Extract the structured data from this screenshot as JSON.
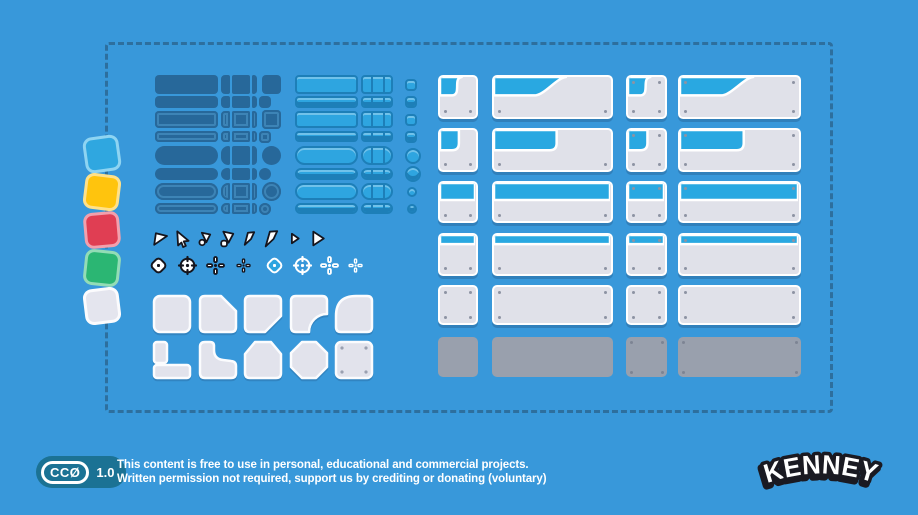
{
  "canvas": {
    "background_color": "#3898da",
    "dashed_border_color": "#2d6f9e"
  },
  "swatches": {
    "items": [
      {
        "name": "blue",
        "fill": "#2fa7e0",
        "border": "#8ed4f2",
        "rotate": -8
      },
      {
        "name": "yellow",
        "fill": "#ffc40d",
        "border": "#ffe189",
        "rotate": 7
      },
      {
        "name": "red",
        "fill": "#e03e53",
        "border": "#f2a0ad",
        "rotate": -5
      },
      {
        "name": "green",
        "fill": "#2bb673",
        "border": "#93dcb6",
        "rotate": 6
      },
      {
        "name": "white",
        "fill": "#e4e5ee",
        "border": "#fbfbfd",
        "rotate": -7
      }
    ]
  },
  "dark_buttons": {
    "color": "#27689a",
    "outline_color": "#3d84b6",
    "rows": [
      {
        "shape": "rect",
        "size": "tall",
        "outline": false,
        "end": "square"
      },
      {
        "shape": "rect",
        "size": "short",
        "outline": false,
        "end": "square"
      },
      {
        "shape": "rect",
        "size": "tall",
        "outline": true,
        "end": "square"
      },
      {
        "shape": "rect",
        "size": "short",
        "outline": true,
        "end": "square"
      },
      {
        "shape": "pill",
        "size": "tall",
        "outline": false,
        "end": "circle"
      },
      {
        "shape": "pill",
        "size": "short",
        "outline": false,
        "end": "circle"
      },
      {
        "shape": "pill",
        "size": "tall",
        "outline": true,
        "end": "circle"
      },
      {
        "shape": "pill",
        "size": "short",
        "outline": true,
        "end": "circle"
      }
    ]
  },
  "light_buttons": {
    "fill": "#2ea5e0",
    "edge": "#1d7fb8",
    "rows": [
      {
        "shape": "rect",
        "size": "tall",
        "style": "flat",
        "end": "square"
      },
      {
        "shape": "rect",
        "size": "tall",
        "style": "bevel",
        "end": "square"
      },
      {
        "shape": "rect",
        "size": "short",
        "style": "flat",
        "end": "square"
      },
      {
        "shape": "rect",
        "size": "short",
        "style": "bevel",
        "end": "square"
      },
      {
        "shape": "pill",
        "size": "tall",
        "style": "flat",
        "end": "circle"
      },
      {
        "shape": "pill",
        "size": "tall",
        "style": "bevel",
        "end": "circle"
      },
      {
        "shape": "pill",
        "size": "short",
        "style": "flat",
        "end": "circle"
      },
      {
        "shape": "pill",
        "size": "short",
        "style": "bevel",
        "end": "circle"
      }
    ]
  },
  "cursors": {
    "stroke": "#15151d",
    "fill": "#ffffff",
    "items": [
      "flag-pointer",
      "arrow-cursor",
      "drag-pointer-small",
      "drag-pointer-large",
      "shard-pointer-small",
      "shard-pointer-large",
      "triangle-pointer-small",
      "triangle-pointer-large"
    ]
  },
  "crosshairs": {
    "dark": "#15151d",
    "light": "#ffffff",
    "accent": "#2ea5e0",
    "items": [
      "diamond-dark",
      "target-dark",
      "plus-dark",
      "plus-small-dark",
      "diamond-light",
      "target-light",
      "plus-light",
      "plus-small-light"
    ]
  },
  "keys": {
    "fill": "#e2e3ec",
    "border": "#fbfcfe",
    "screw": "#9aa0b0",
    "rows": [
      [
        "square",
        "cut-top-right",
        "cut-bottom-right",
        "notch-bottom-right",
        "round-top-left"
      ],
      [
        "l-shape",
        "l-curve",
        "arch-top",
        "octagon",
        "screw-plate"
      ]
    ]
  },
  "panels": {
    "body_color": "#e0e1e9",
    "border_color": "#ffffff",
    "header_color": "#29a8e1",
    "screw_color": "#8d93a3",
    "disabled_color": "#99a0ad",
    "disabled_screw_color": "#7d8494",
    "col_x": [
      438,
      492,
      626,
      678
    ],
    "col_w": [
      40,
      121,
      41,
      123
    ],
    "row_y": [
      75,
      128,
      181,
      233,
      285,
      337
    ],
    "row_h": [
      44,
      44,
      42,
      43,
      40,
      40
    ],
    "rows": [
      {
        "variant": "header-diagonal",
        "screws": [
          "bottom",
          "bottom",
          "all",
          "all"
        ]
      },
      {
        "variant": "header-tab",
        "screws": [
          "bottom",
          "bottom",
          "all",
          "all"
        ]
      },
      {
        "variant": "header-half",
        "screws": [
          "bottom",
          "bottom",
          "all",
          "all"
        ]
      },
      {
        "variant": "header-thin",
        "screws": [
          "bottom",
          "bottom",
          "all",
          "all"
        ]
      },
      {
        "variant": "plain",
        "screws": [
          "all",
          "all",
          "all",
          "all"
        ]
      },
      {
        "variant": "disabled",
        "screws": [
          "none",
          "none",
          "all",
          "all"
        ]
      }
    ]
  },
  "footer": {
    "badge": {
      "label": "CCØ",
      "version": "1.0",
      "pill_color": "#1b7294"
    },
    "license_line1": "This content is free to use in personal, educational and commercial projects.",
    "license_line2": "Written permission not required, support us by crediting or donating (voluntary)",
    "logo_text": "KENNEY"
  }
}
